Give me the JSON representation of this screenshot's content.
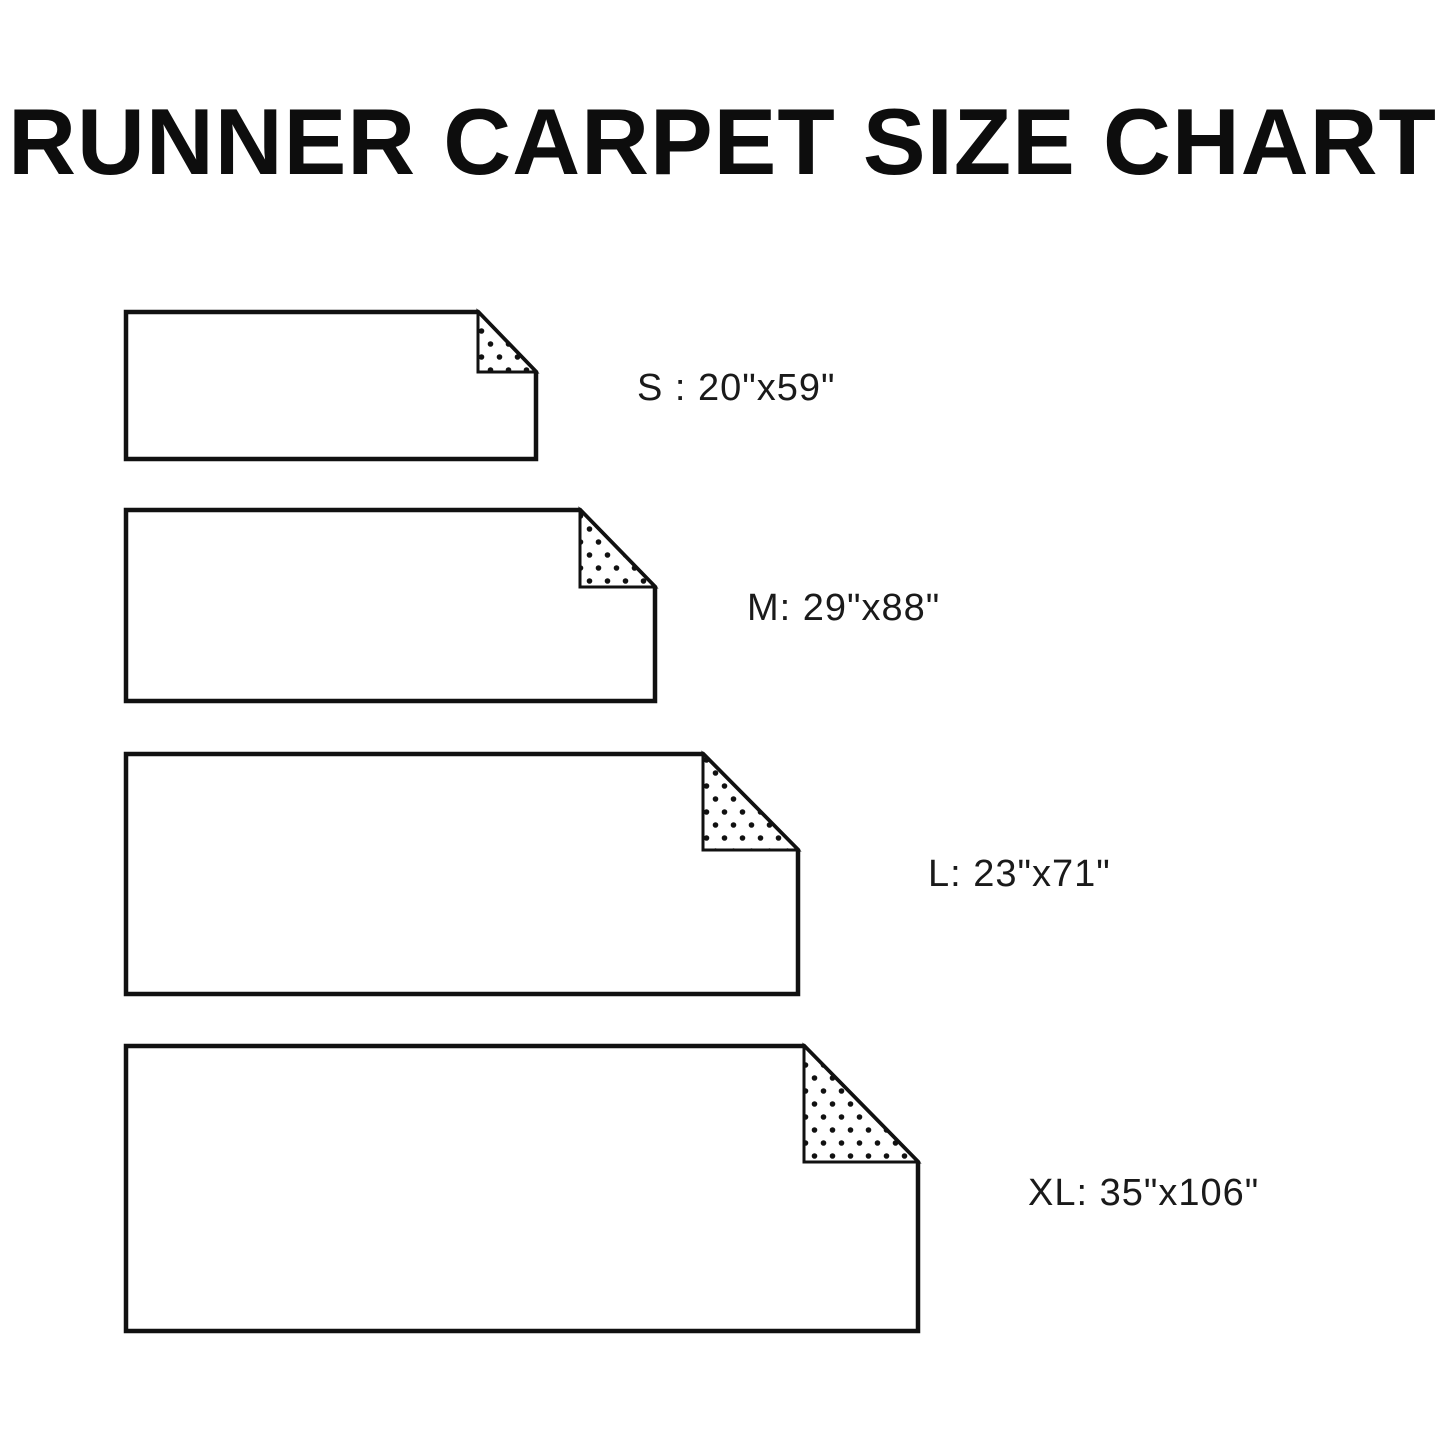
{
  "title": "RUNNER CARPET SIZE CHART",
  "sizes": [
    {
      "code": "S",
      "dimensions": "20\"x59\"",
      "label": "S : 20\"x59\""
    },
    {
      "code": "M",
      "dimensions": "29\"x88\"",
      "label": "M: 29\"x88\""
    },
    {
      "code": "L",
      "dimensions": "23\"x71\"",
      "label": "L: 23\"x71\""
    },
    {
      "code": "XL",
      "dimensions": "35\"x106\"",
      "label": "XL: 35\"x106\""
    }
  ],
  "colors": {
    "background": "#ffffff",
    "line": "#111111",
    "text": "#1a1a1a"
  }
}
